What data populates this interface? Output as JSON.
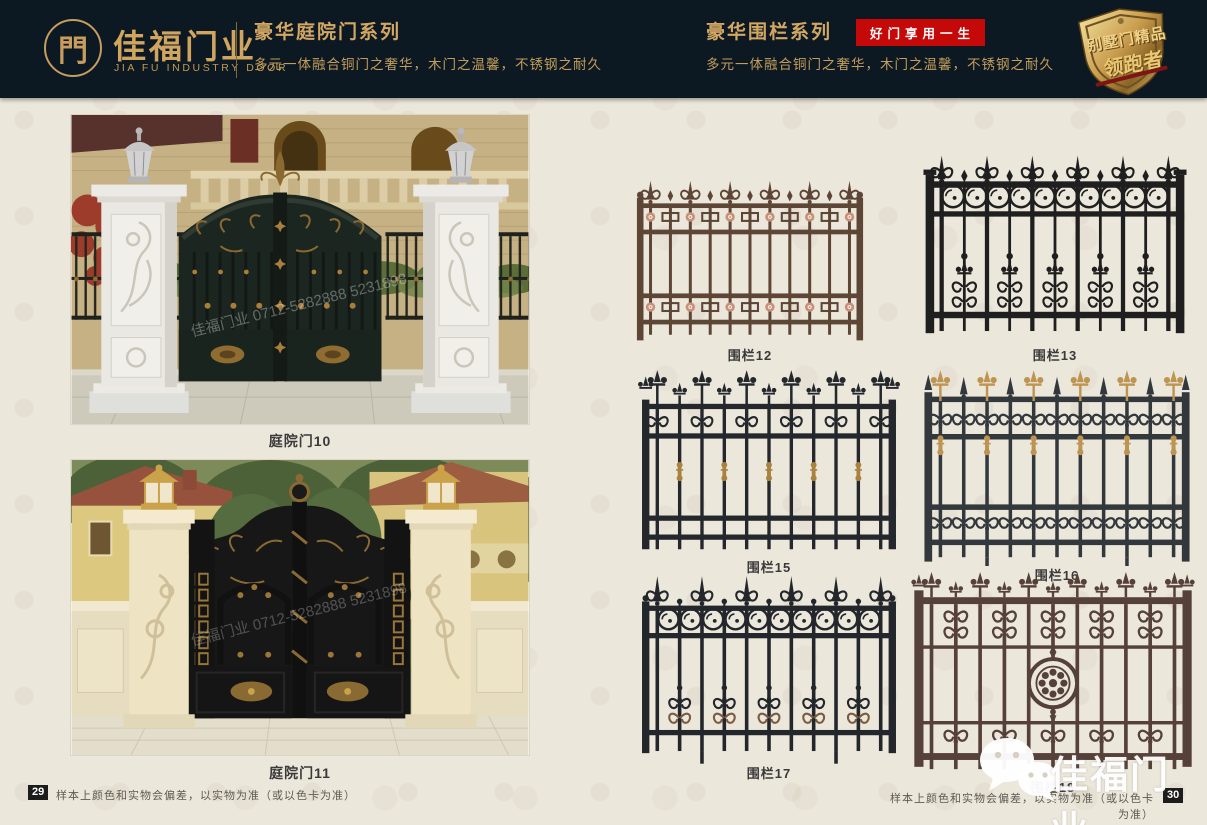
{
  "header": {
    "background": "#0d1922",
    "accent_color": "#cfa55f",
    "brand": {
      "logo_glyph": "門",
      "name": "佳福门业",
      "name_en": "JIA FU INDUSTRY DOOR"
    },
    "left_series": {
      "title": "豪华庭院门系列",
      "subtitle": "多元一体融合铜门之奢华，木门之温馨，不锈钢之耐久"
    },
    "right_series": {
      "title": "豪华围栏系列",
      "badge": "好门享用一生",
      "badge_color": "#c50808",
      "subtitle": "多元一体融合铜门之奢华，木门之温馨，不锈钢之耐久"
    },
    "emblem": {
      "line1": "别墅门精品",
      "line2": "领跑者"
    }
  },
  "products": {
    "gates": [
      {
        "label": "庭院门10"
      },
      {
        "label": "庭院门11"
      }
    ],
    "fences": [
      {
        "label": "围栏12",
        "style": "rosette",
        "frame": "#5e4636",
        "accent": "#c8907a"
      },
      {
        "label": "围栏13",
        "style": "ringsFleur",
        "frame": "#1f1f1f",
        "accent": "#1f1f1f"
      },
      {
        "label": "围栏15",
        "style": "fleurCollar",
        "frame": "#24282c",
        "accent": "#a9823f"
      },
      {
        "label": "围栏16",
        "style": "scrollGold",
        "frame": "#33383d",
        "accent": "#bd9452"
      },
      {
        "label": "围栏17",
        "style": "ringsScroll",
        "frame": "#23272c",
        "accent": "#7a5c43"
      },
      {
        "label": "围栏18",
        "style": "medallion",
        "frame": "#56413a",
        "accent": "#6d5248"
      }
    ]
  },
  "footer": {
    "left_page_number": "29",
    "right_page_number": "30",
    "disclaimer_left": "样本上颜色和实物会偏差，以实物为准（或以色卡为准）",
    "disclaimer_right": "样本上颜色和实物会偏差，以实物为准（或以色卡为准）"
  },
  "watermarks": {
    "photo": "佳福门业 0712-5282888 5231898",
    "corner_brand": "佳福门业"
  }
}
